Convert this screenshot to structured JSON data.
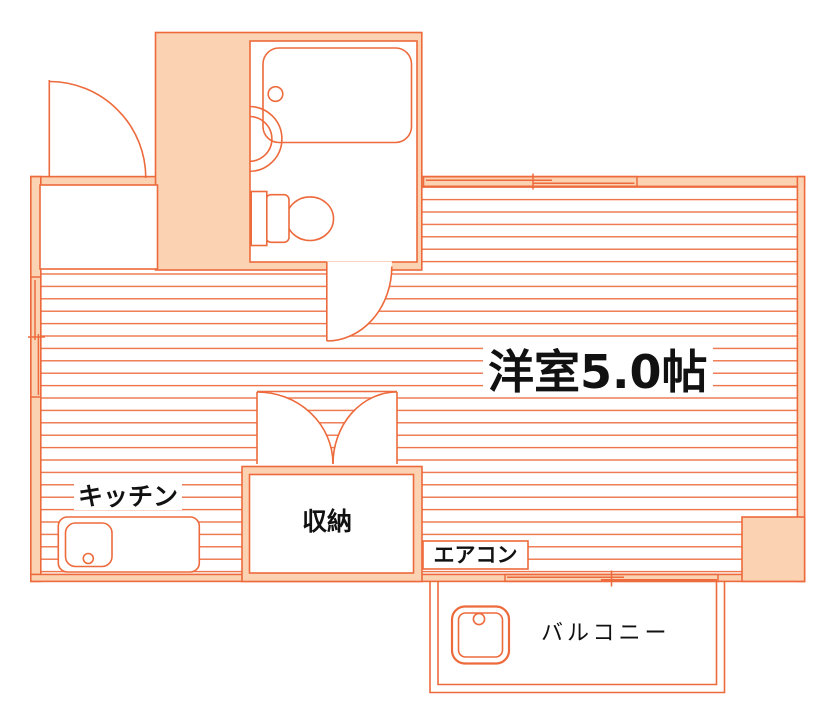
{
  "floorplan": {
    "labels": {
      "main_room": "洋室5.0帖",
      "kitchen": "キッチン",
      "storage": "収納",
      "aircon": "エアコン",
      "balcony": "バルコニー"
    },
    "colors": {
      "outline": "#ed6a3c",
      "wall_fill": "#fbd2b2",
      "floor_stripe": "#ed6a3c",
      "text": "#111111",
      "background": "#ffffff"
    },
    "fixtures": [
      "entrance-door",
      "bathtub",
      "bathtub-drain",
      "wash-basin",
      "toilet",
      "bathroom-door",
      "sliding-window-top",
      "sliding-window-left",
      "closet-double-doors",
      "kitchen-counter",
      "kitchen-sink",
      "air-conditioner-box",
      "corner-pillar",
      "balcony-sliding-door",
      "washing-machine-pan"
    ]
  }
}
